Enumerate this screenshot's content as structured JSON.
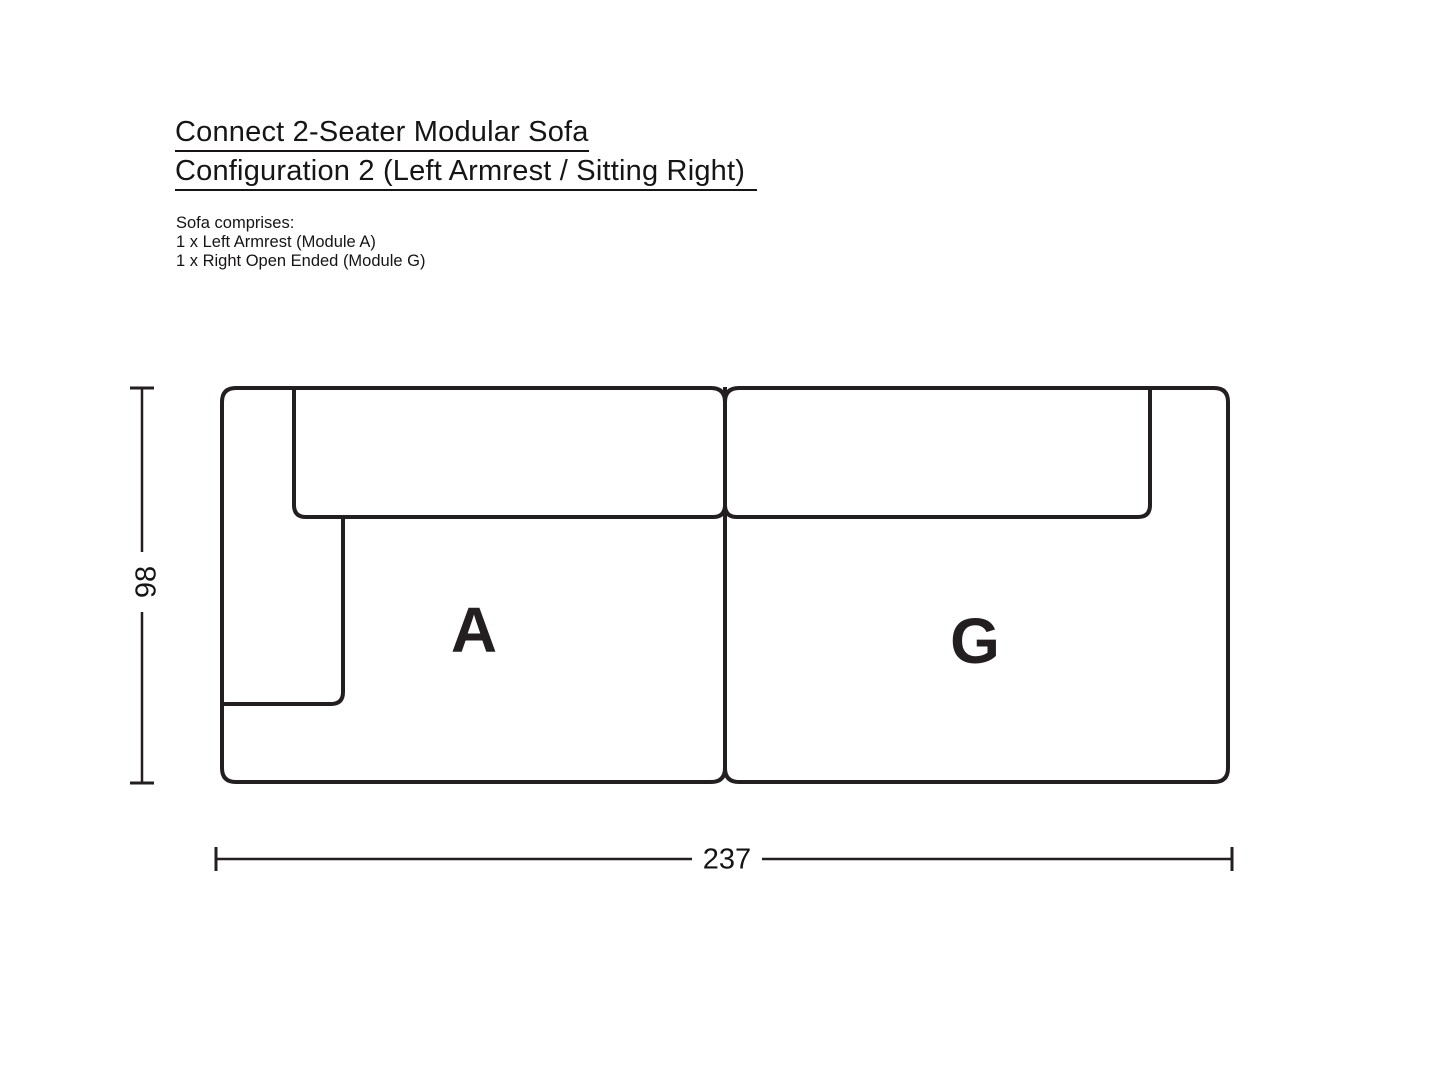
{
  "title": {
    "line1": "Connect 2-Seater Modular Sofa",
    "line2": "Configuration 2 (Left Armrest / Sitting Right)"
  },
  "description": {
    "intro": "Sofa comprises:",
    "items": [
      "1 x Left Armrest (Module A)",
      "1 x Right Open Ended (Module G)"
    ]
  },
  "diagram": {
    "line_color": "#231f20",
    "modules": [
      {
        "label": "A"
      },
      {
        "label": "G"
      }
    ],
    "dimensions": {
      "height": "98",
      "width": "237"
    }
  }
}
